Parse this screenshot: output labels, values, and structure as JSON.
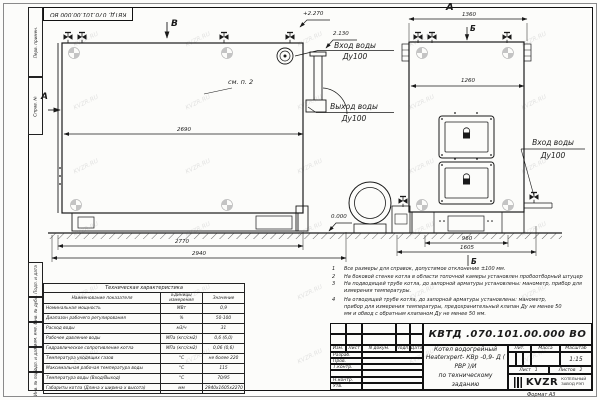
{
  "colors": {
    "line": "#1a1a1a",
    "paper": "#fcfcfa",
    "watermark": "#cccccc"
  },
  "watermark": {
    "text": "KVZR.RU"
  },
  "corner_stamp": "КВТД. 070.101.00.000 ВО",
  "frame": {
    "left_strip": [
      "Перв. примен.",
      "Справ. №",
      "Подп. и дата",
      "Инв. № дубл.",
      "Взам. инв. №",
      "Подп. и дата",
      "Инв. № подл."
    ],
    "format_label": "Формат  А3"
  },
  "views": {
    "side": {
      "label_v": "В",
      "label_a": "А",
      "see_note": "см. п. 2",
      "elev_top": "+2.270",
      "elev_inlet": "2.130",
      "inlet": {
        "line1": "Вход воды",
        "line2": "Ду100"
      },
      "outlet": {
        "line1": "Выход воды",
        "line2": "Ду100"
      },
      "dims": {
        "top": "2690",
        "mid": "2770",
        "bottom": "2940"
      }
    },
    "front": {
      "label_a": "А",
      "label_b_top": "Б",
      "label_b_bottom": "Б",
      "elev_zero": "0.000",
      "inlet": {
        "line1": "Вход воды",
        "line2": "Ду100"
      },
      "dims": {
        "overall_w": "1360",
        "inner_w": "1260",
        "base_w": "960",
        "full_w": "1605"
      }
    }
  },
  "notes": [
    {
      "num": "1",
      "text": "Все размеры для справок, допустимое отклонение ±100 мм."
    },
    {
      "num": "2",
      "text": "На боковой стенке котла в области топочной камеры установлен пробоотборный штуцер"
    },
    {
      "num": "3",
      "text": "На подводящей трубе котла, до запорной арматуры установлены: манометр, прибор для измерения температуры."
    },
    {
      "num": "4",
      "text": "На отводящей трубе котла, до запорной арматуры установлены: манометр, прибор для измерения температуры, предохранительный клапан Ду не менее 50 мм и обвод с обратным клапаном Ду не менее 50 мм."
    }
  ],
  "tech_table": {
    "title": "Техническая характеристика",
    "headers": {
      "name": "Наименование показателя",
      "units": "Единицы измерения",
      "value": "Значение"
    },
    "rows": [
      {
        "name": "Номинальная мощность",
        "units": "МВт",
        "value": "0,9"
      },
      {
        "name": "Диапазон рабочего регулирования",
        "units": "%",
        "value": "50-100"
      },
      {
        "name": "Расход воды",
        "units": "м3/ч",
        "value": "31"
      },
      {
        "name": "Рабочее давление воды",
        "units": "МПа (кгс/см2)",
        "value": "0,6 (6,0)"
      },
      {
        "name": "Гидравлическое сопротивление котла",
        "units": "МПа (кгс/см2)",
        "value": "0,06 (0,6)"
      },
      {
        "name": "Температура уходящих газов",
        "units": "°С",
        "value": "не более 220"
      },
      {
        "name": "Максимальная рабочая температура воды",
        "units": "°С",
        "value": "115"
      },
      {
        "name": "Температура воды (Вход/Выход)",
        "units": "°С",
        "value": "70/95"
      },
      {
        "name": "Габариты котла (Длина х ширина х высота)",
        "units": "мм",
        "value": "2940х1605х2270"
      }
    ]
  },
  "title_block": {
    "doc_number": "КВТД .070.101.00.000  ВО",
    "cols": [
      "Изм.",
      "Лист",
      "N докум.",
      "Подп.",
      "Дата"
    ],
    "rows": [
      "Разраб.",
      "Пров.",
      "Т.контр.",
      "",
      "Н.контр.",
      "Утв."
    ],
    "product": {
      "line1": "Котел водогрейный",
      "line2": "Heaterxpert- КВр -0,9- Д ( РВР )/И",
      "line3": "по техническому заданию"
    },
    "lit_label": "Лит.",
    "mass_label": "Масса",
    "scale_label": "Масштаб",
    "scale_value": "1:15",
    "sheet_label": "Лист",
    "sheet_value": "1",
    "sheets_label": "Листов",
    "sheets_value": "2",
    "logo_text": "KVZR",
    "org_line1": "КОТЕЛЬНЫЙ",
    "org_line2": "ЗАВОД РЭП"
  }
}
